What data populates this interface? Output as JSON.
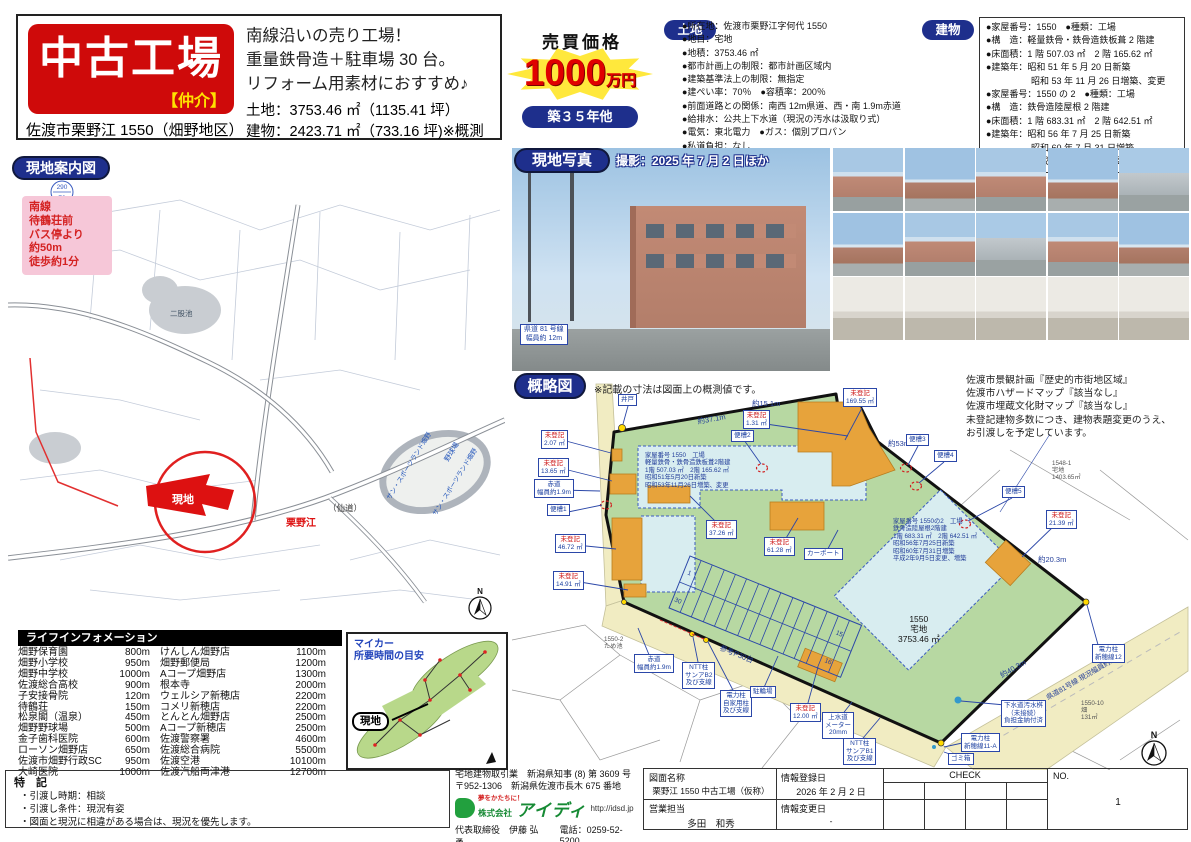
{
  "header": {
    "title": "中古工場",
    "broker": "【仲介】",
    "address": "佐渡市栗野江 1550（畑野地区）",
    "catch": [
      "南線沿いの売り工場！",
      "重量鉄骨造＋駐車場 30 台。",
      "リフォーム用素材におすすめ♪"
    ],
    "land_summary": "土地：3753.46 ㎡（1135.41 坪）",
    "building_summary": "建物：2423.71 ㎡（733.16 坪)※概測"
  },
  "price": {
    "label": "売買価格",
    "value": "1000",
    "unit": "万円",
    "age": "築３５年他"
  },
  "land": {
    "label": "土地",
    "items": [
      "●所在地：佐渡市栗野江字何代 1550",
      "●地目：宅地",
      "●地積：3753.46 ㎡",
      "●都市計画上の制限：都市計画区域内",
      "●建築基準法上の制限：無指定",
      "●建ぺい率：70％　●容積率：200％",
      "●前面道路との関係：南西 12m県道、西・南 1.9m赤道",
      "●給排水：公共上下水道（現況の汚水は汲取り式）",
      "●電気：東北電力　●ガス：個別プロパン",
      "●私道負担：なし",
      "●校区：畑野小学校、畑野中学校"
    ]
  },
  "building": {
    "label": "建物",
    "items": [
      "●家屋番号：1550　●種類：工場",
      "●構　造：軽量鉄骨・鉄骨造鉄板葺 2 階建",
      "●床面積：1 階 507.03 ㎡　2 階 165.62 ㎡",
      "●建築年：昭和 51 年 5 月 20 日新築",
      "　　　　　昭和 53 年 11 月 26 日増築、変更",
      "●家屋番号：1550 の 2　●種類：工場",
      "●構　造：鉄骨造陸屋根 2 階建",
      "●床面積：1 階 683.31 ㎡　2 階 642.51 ㎡",
      "●建築年：昭和 56 年 7 月 25 日新築",
      "　　　　　昭和 60 年 7 月 31 日増築",
      "　　　　　平成 2 年 9 月 5 日変更、増築"
    ]
  },
  "guide_map": {
    "label": "現地案内図",
    "access_lines": [
      "南線",
      "待鶴荘前",
      "バス停より",
      "約50m",
      "徒歩約1分"
    ],
    "site": "現地",
    "kurinoe": "栗野江",
    "sendo": "（仙道）",
    "sports_land": "サン・スポーツランド畑野",
    "ballpark": "野球場",
    "pond": "二股池",
    "benchmark_top": "290",
    "benchmark_bottom": "70",
    "compass": "N"
  },
  "photos": {
    "label": "現地写真",
    "note": "撮影：2025 年 7 月 2 日ほか",
    "road_caption": "県道 81 号線\n幅員約 12m"
  },
  "sketch": {
    "label": "概略図",
    "note": "※記載の寸法は図面上の概測値です。",
    "side_notes": [
      "佐渡市景観計画『歴史的市街地区域』",
      "佐渡市ハザードマップ『該当なし』",
      "佐渡市埋蔵文化財マップ『該当なし』",
      "未登記建物多数につき、建物表題変更のうえ、",
      "お引渡しを予定しています。"
    ],
    "unreg": "未登記",
    "areas": {
      "a207": "2.07 ㎡",
      "a1365": "13.65 ㎡",
      "a4672": "46.72 ㎡",
      "a1491": "14.91 ㎡",
      "a3726": "37.26 ㎡",
      "a6128": "61.28 ㎡",
      "a131": "1.31 ㎡",
      "a16955": "169.55 ㎡",
      "a2139": "21.39 ㎡",
      "a1200": "12.00 ㎡"
    },
    "tanks": {
      "t1": "便槽1",
      "t2": "便槽2",
      "t3": "便槽3",
      "t4": "便槽4",
      "t5": "便槽5"
    },
    "well": "井戸",
    "carport": "カーポート",
    "bike_shed": "駐輪場",
    "trash": "ゴミ箱",
    "water_meter": "上水道\nメーター\n20mm",
    "ntt_b2": "NTT柱\nサンアB2\n及び支線",
    "ntt_b1": "NTT柱\nサンアB1\n及び支線",
    "pole_private": "電力柱\n自家用柱\n及び支線",
    "pole_12": "電力柱\n新穂線12",
    "pole_11a": "電力柱\n新穂線11-A",
    "sewer": "下水道汚水桝\n（未接続）\n負担金納付済",
    "akamichi": "赤道\n幅員約1.9m",
    "dims": {
      "d371": "約37.1m",
      "d151": "約15.1m",
      "d53": "約53m",
      "d203": "約20.3m",
      "d403": "約40.3m"
    },
    "bldg1": [
      "家屋番号 1550　工場",
      "軽量鉄骨・鉄骨造鉄板葺2階建",
      "1階 507.03 ㎡　2階 165.62 ㎡",
      "昭和51年5月20日新築",
      "昭和53年11月26日増築、変更"
    ],
    "bldg2": [
      "家屋番号 1550の2　工場",
      "鉄骨造陸屋根2階建",
      "1階 683.31 ㎡　2階 642.51 ㎡",
      "昭和56年7月25日新築",
      "昭和60年7月31日増築",
      "平成2年9月5日変更、増築"
    ],
    "lot": "1550\n宅地\n3753.46 ㎡",
    "parking_ref": "参考P30台",
    "stalls": {
      "s1": "1",
      "s15": "15",
      "s16": "16",
      "s30": "30"
    },
    "road": "県道81号線 現況幅員約12m",
    "neighbors": {
      "n1548": "1548-1\n宅地\n1403.65㎡",
      "n1550_2": "1550-2\nため池",
      "n1550_10": "1550-10\n畑\n131㎡"
    },
    "compass": "N"
  },
  "life": {
    "header": "ライフインフォメーション",
    "rows": [
      [
        "畑野保育園",
        "800m",
        "けんしん畑野店",
        "1100m"
      ],
      [
        "畑野小学校",
        "950m",
        "畑野郵便局",
        "1200m"
      ],
      [
        "畑野中学校",
        "1000m",
        "Aコープ畑野店",
        "1300m"
      ],
      [
        "佐渡総合高校",
        "900m",
        "根本寺",
        "2000m"
      ],
      [
        "子安接骨院",
        "120m",
        "ウェルシア新穂店",
        "2200m"
      ],
      [
        "待鶴荘",
        "150m",
        "コメリ新穂店",
        "2200m"
      ],
      [
        "松泉閣（温泉）",
        "450m",
        "とんとん畑野店",
        "2500m"
      ],
      [
        "畑野野球場",
        "500m",
        "Aコープ新穂店",
        "2500m"
      ],
      [
        "金子歯科医院",
        "600m",
        "佐渡警察署",
        "4600m"
      ],
      [
        "ローソン畑野店",
        "650m",
        "佐渡総合病院",
        "5500m"
      ],
      [
        "佐渡市畑野行政SC",
        "950m",
        "佐渡空港",
        "10100m"
      ],
      [
        "大崎医院",
        "1000m",
        "佐渡汽船両津港",
        "12700m"
      ]
    ]
  },
  "mycar": {
    "title": "マイカー\n所要時間の目安",
    "site": "現地"
  },
  "notes": {
    "header": "特　記",
    "items": [
      "・引渡し時期：相談",
      "・引渡し条件：現況有姿",
      "・図面と現況に相違がある場合は、現況を優先します。"
    ]
  },
  "company": {
    "license": "宅地建物取引業　新潟県知事 (8) 第 3609 号",
    "postal": "〒952-1306　新潟県佐渡市長木 675 番地",
    "tagline": "夢をかたちに！",
    "name_prefix": "株式会社",
    "name": "アイディ",
    "url": "http://idsd.jp",
    "rep": "代表取締役　伊藤 弘勇",
    "phone": "電話：0259-52-5200"
  },
  "doc": {
    "name_label": "図面名称",
    "name_value": "栗野江 1550 中古工場（仮称）",
    "reg_label": "情報登録日",
    "reg_value": "2026 年 2 月 2 日",
    "sales_label": "営業担当",
    "sales_value": "多田　和秀",
    "change_label": "情報変更日",
    "change_value": "-",
    "check_label": "CHECK",
    "no_label": "NO.",
    "no_value": "1"
  }
}
